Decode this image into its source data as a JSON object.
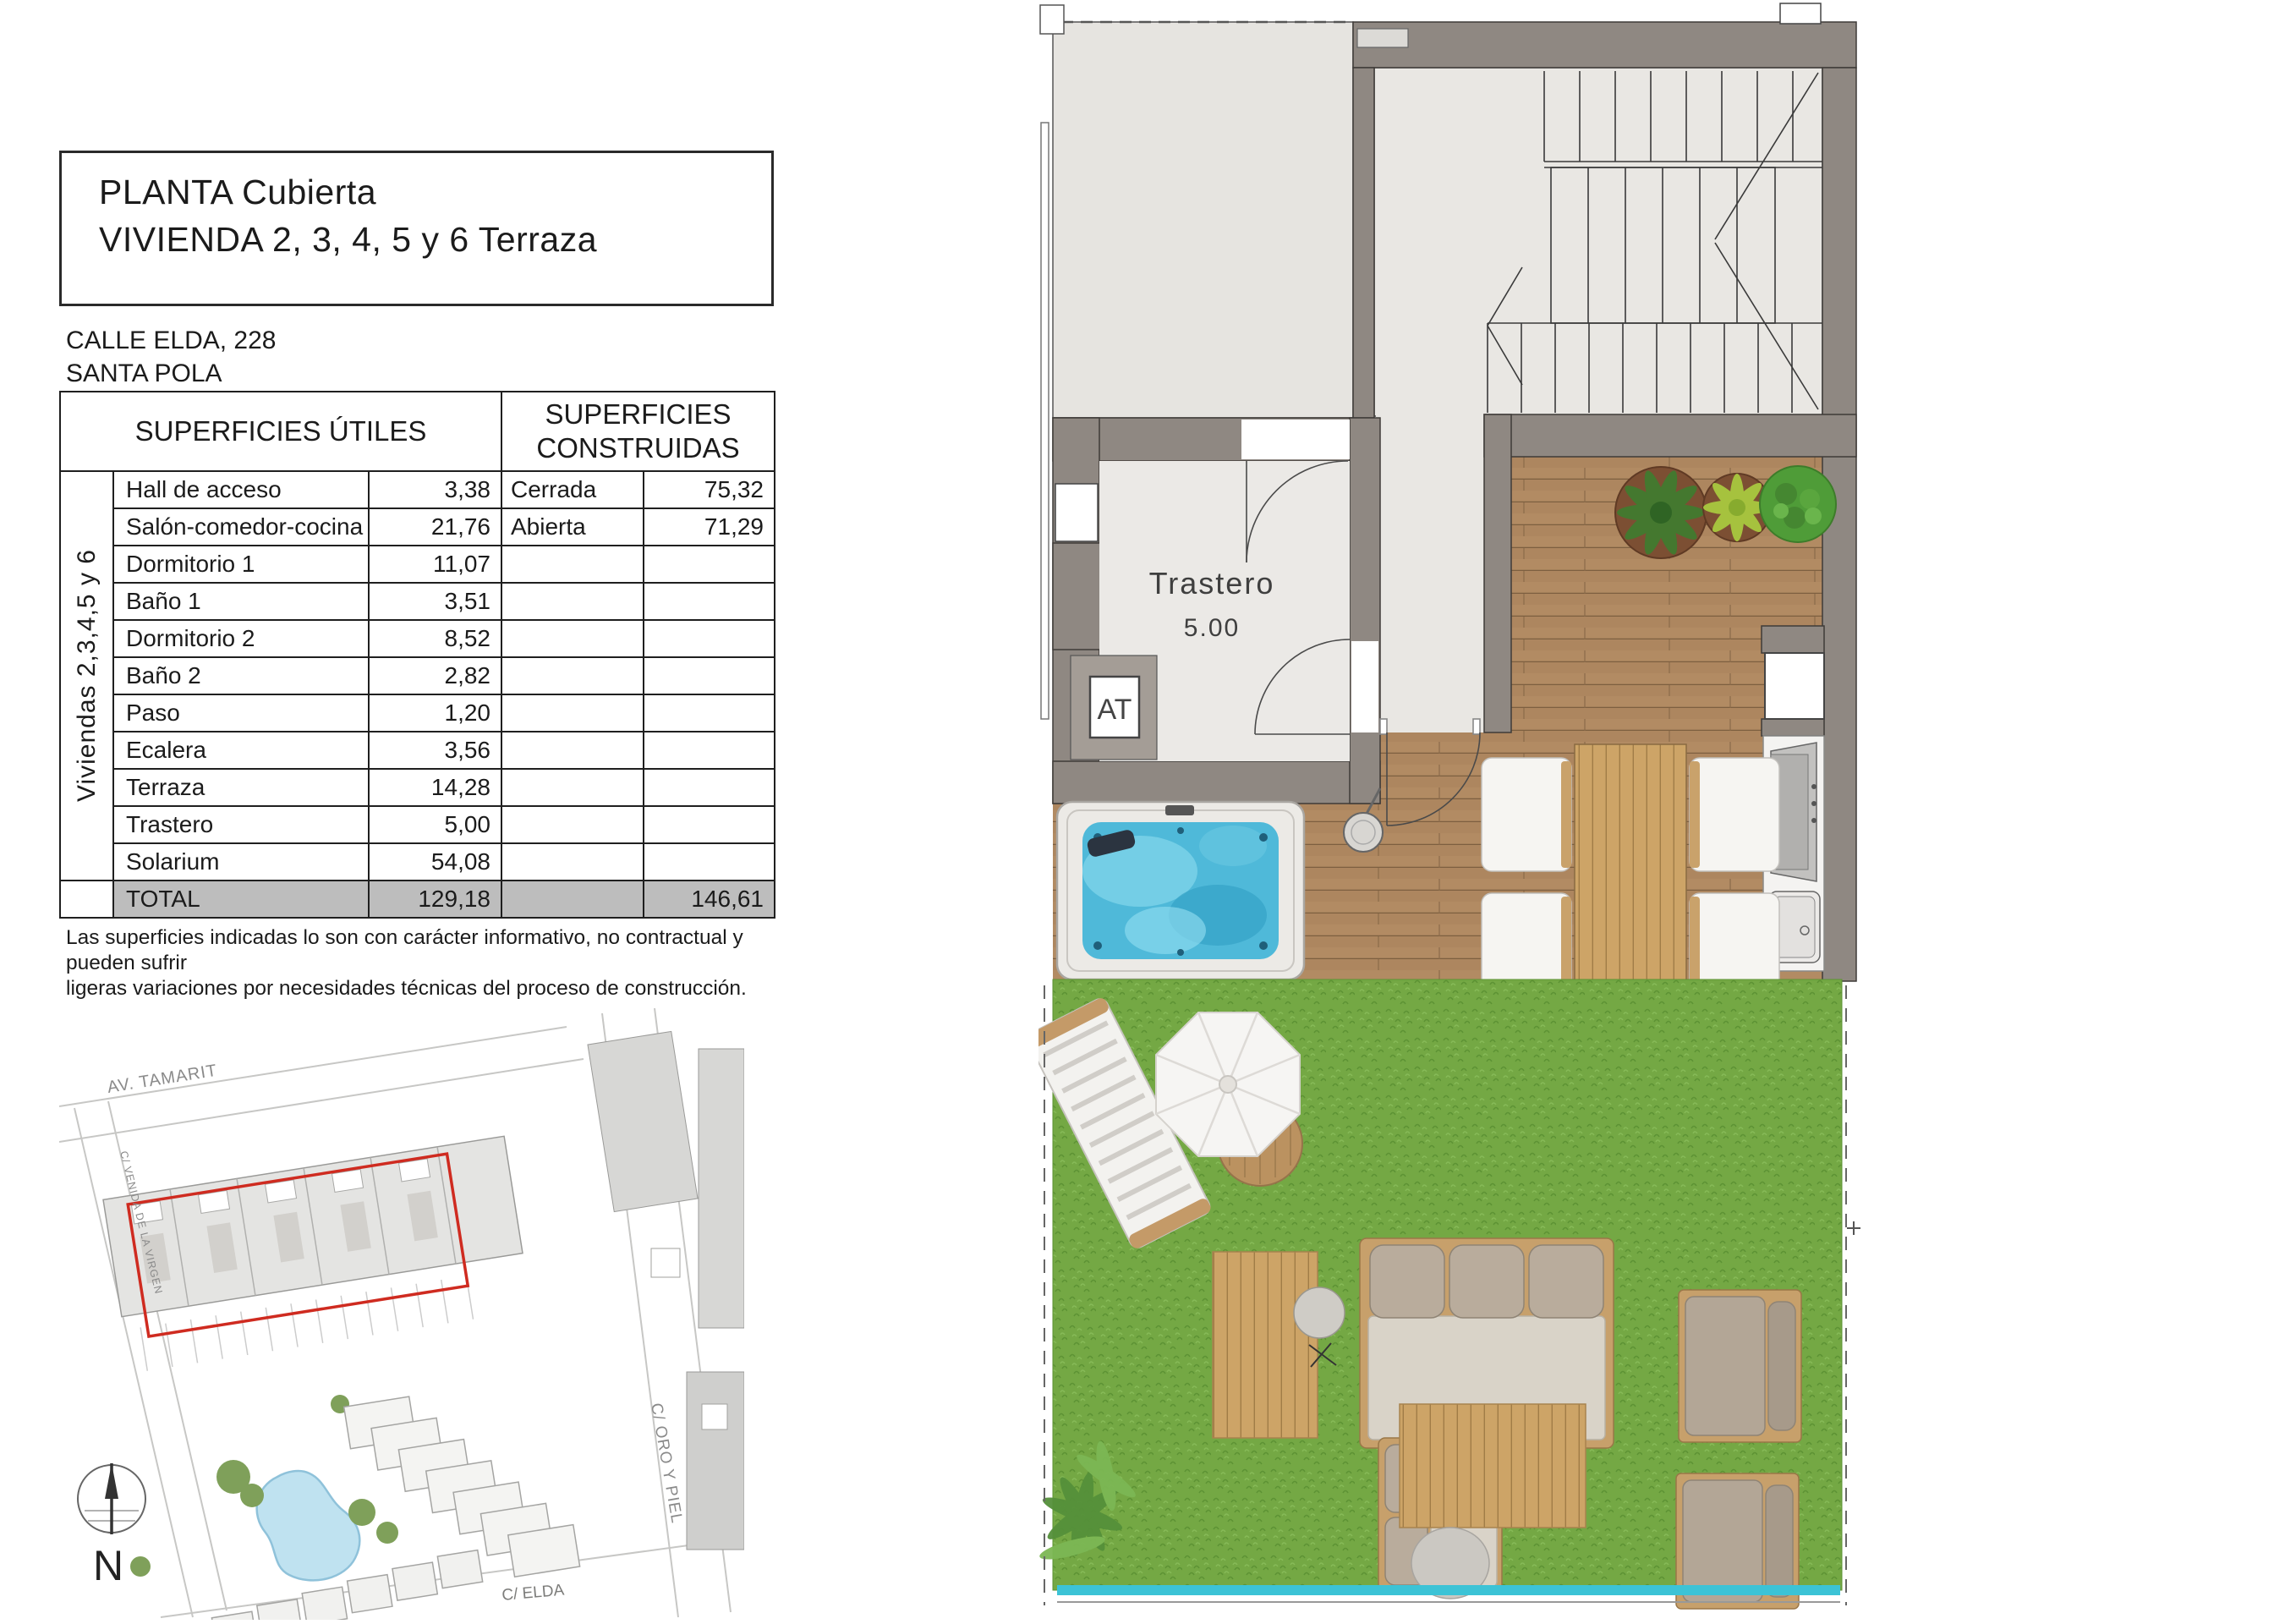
{
  "document": {
    "title_line1": "PLANTA Cubierta",
    "title_line2": "VIVIENDA 2, 3, 4, 5 y 6 Terraza",
    "address_line1": "CALLE ELDA, 228",
    "address_line2": "SANTA POLA",
    "table": {
      "header_left": "SUPERFICIES ÚTILES",
      "header_right": "SUPERFICIES CONSTRUIDAS",
      "row_group_label": "Viviendas 2,3,4,5 y 6",
      "rows": [
        {
          "name": "Hall de acceso",
          "useful": "3,38",
          "constructed_name": "Cerrada",
          "constructed_value": "75,32"
        },
        {
          "name": "Salón-comedor-cocina",
          "useful": "21,76",
          "constructed_name": "Abierta",
          "constructed_value": "71,29"
        },
        {
          "name": "Dormitorio 1",
          "useful": "11,07",
          "constructed_name": "",
          "constructed_value": ""
        },
        {
          "name": "Baño 1",
          "useful": "3,51",
          "constructed_name": "",
          "constructed_value": ""
        },
        {
          "name": "Dormitorio 2",
          "useful": "8,52",
          "constructed_name": "",
          "constructed_value": ""
        },
        {
          "name": "Baño 2",
          "useful": "2,82",
          "constructed_name": "",
          "constructed_value": ""
        },
        {
          "name": "Paso",
          "useful": "1,20",
          "constructed_name": "",
          "constructed_value": ""
        },
        {
          "name": "Ecalera",
          "useful": "3,56",
          "constructed_name": "",
          "constructed_value": ""
        },
        {
          "name": "Terraza",
          "useful": "14,28",
          "constructed_name": "",
          "constructed_value": ""
        },
        {
          "name": "Trastero",
          "useful": "5,00",
          "constructed_name": "",
          "constructed_value": ""
        },
        {
          "name": "Solarium",
          "useful": "54,08",
          "constructed_name": "",
          "constructed_value": ""
        }
      ],
      "total": {
        "label": "TOTAL",
        "useful": "129,18",
        "constructed": "146,61"
      }
    },
    "disclaimer_line1": "Las superficies indicadas lo son con carácter informativo, no contractual y pueden sufrir",
    "disclaimer_line2": "ligeras variaciones por necesidades técnicas del proceso de construcción."
  },
  "floor_plan": {
    "storage_label": "Trastero",
    "storage_area": "5.00",
    "hatch_label": "AT"
  },
  "site_map": {
    "street_top": "AV. TAMARIT",
    "street_right": "C/ ORO Y PIEL",
    "street_bottom": "C/ ELDA",
    "street_left": "C/ VENIDA DE LA VIRGEN",
    "compass": "N"
  },
  "colors": {
    "wall_taupe": "#8f8882",
    "deck_wood": "#b28b63",
    "grass_green": "#74a844",
    "jacuzzi_water": "#4fb9d9",
    "highlight_red": "#cf2b20",
    "railing_teal": "#3cc3d6",
    "pool_blue": "#bfe2f0",
    "total_row_gray": "#bdbdbd"
  }
}
